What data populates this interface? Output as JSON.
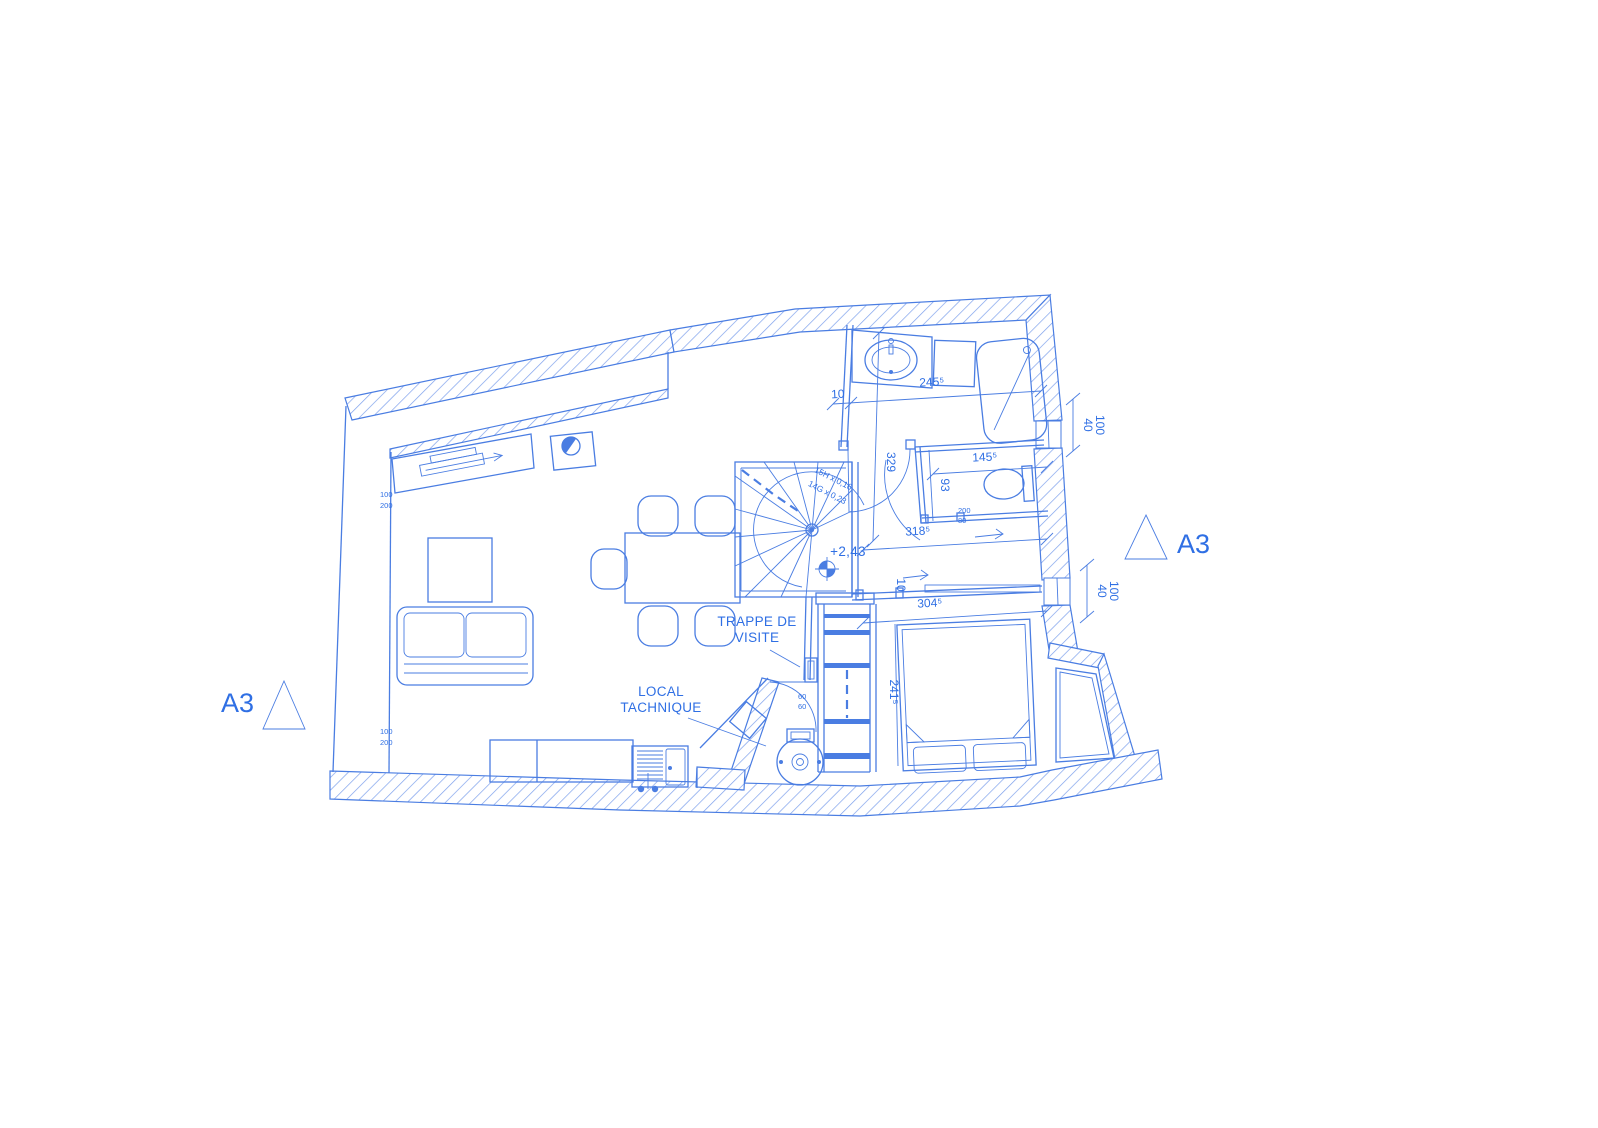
{
  "colors": {
    "line": "#4a7de2",
    "hatch": "#7ea1ec",
    "text": "#2f6fe4",
    "background": "#ffffff"
  },
  "markers": {
    "left_label": "A3",
    "right_label": "A3"
  },
  "annotations": {
    "trappe_line1": "TRAPPE DE",
    "trappe_line2": "VISITE",
    "local_line1": "LOCAL",
    "local_line2": "TACHNIQUE",
    "level": "+2,43",
    "stair_note1": "15H x 0,16",
    "stair_note2": "14G x 0,23"
  },
  "dimensions": {
    "bath_gap": "10",
    "bath_width": "245⁵",
    "stair_opening": "329",
    "wc_width": "145⁵",
    "wc_depth": "93",
    "hall_width": "318⁵",
    "bed_gap": "10",
    "bedroom_width": "304⁵",
    "bedroom_depth": "241⁵",
    "window_right_top_w": "40",
    "window_right_top_h": "100",
    "window_right_mid_w": "40",
    "window_right_mid_h": "100",
    "window_left_top_a": "100",
    "window_left_top_b": "200",
    "window_left_bottom_a": "100",
    "window_left_bottom_b": "200",
    "door_hall_w": "60",
    "door_hall_h": "60",
    "wc_door_h": "200",
    "wc_door_w": "80"
  }
}
